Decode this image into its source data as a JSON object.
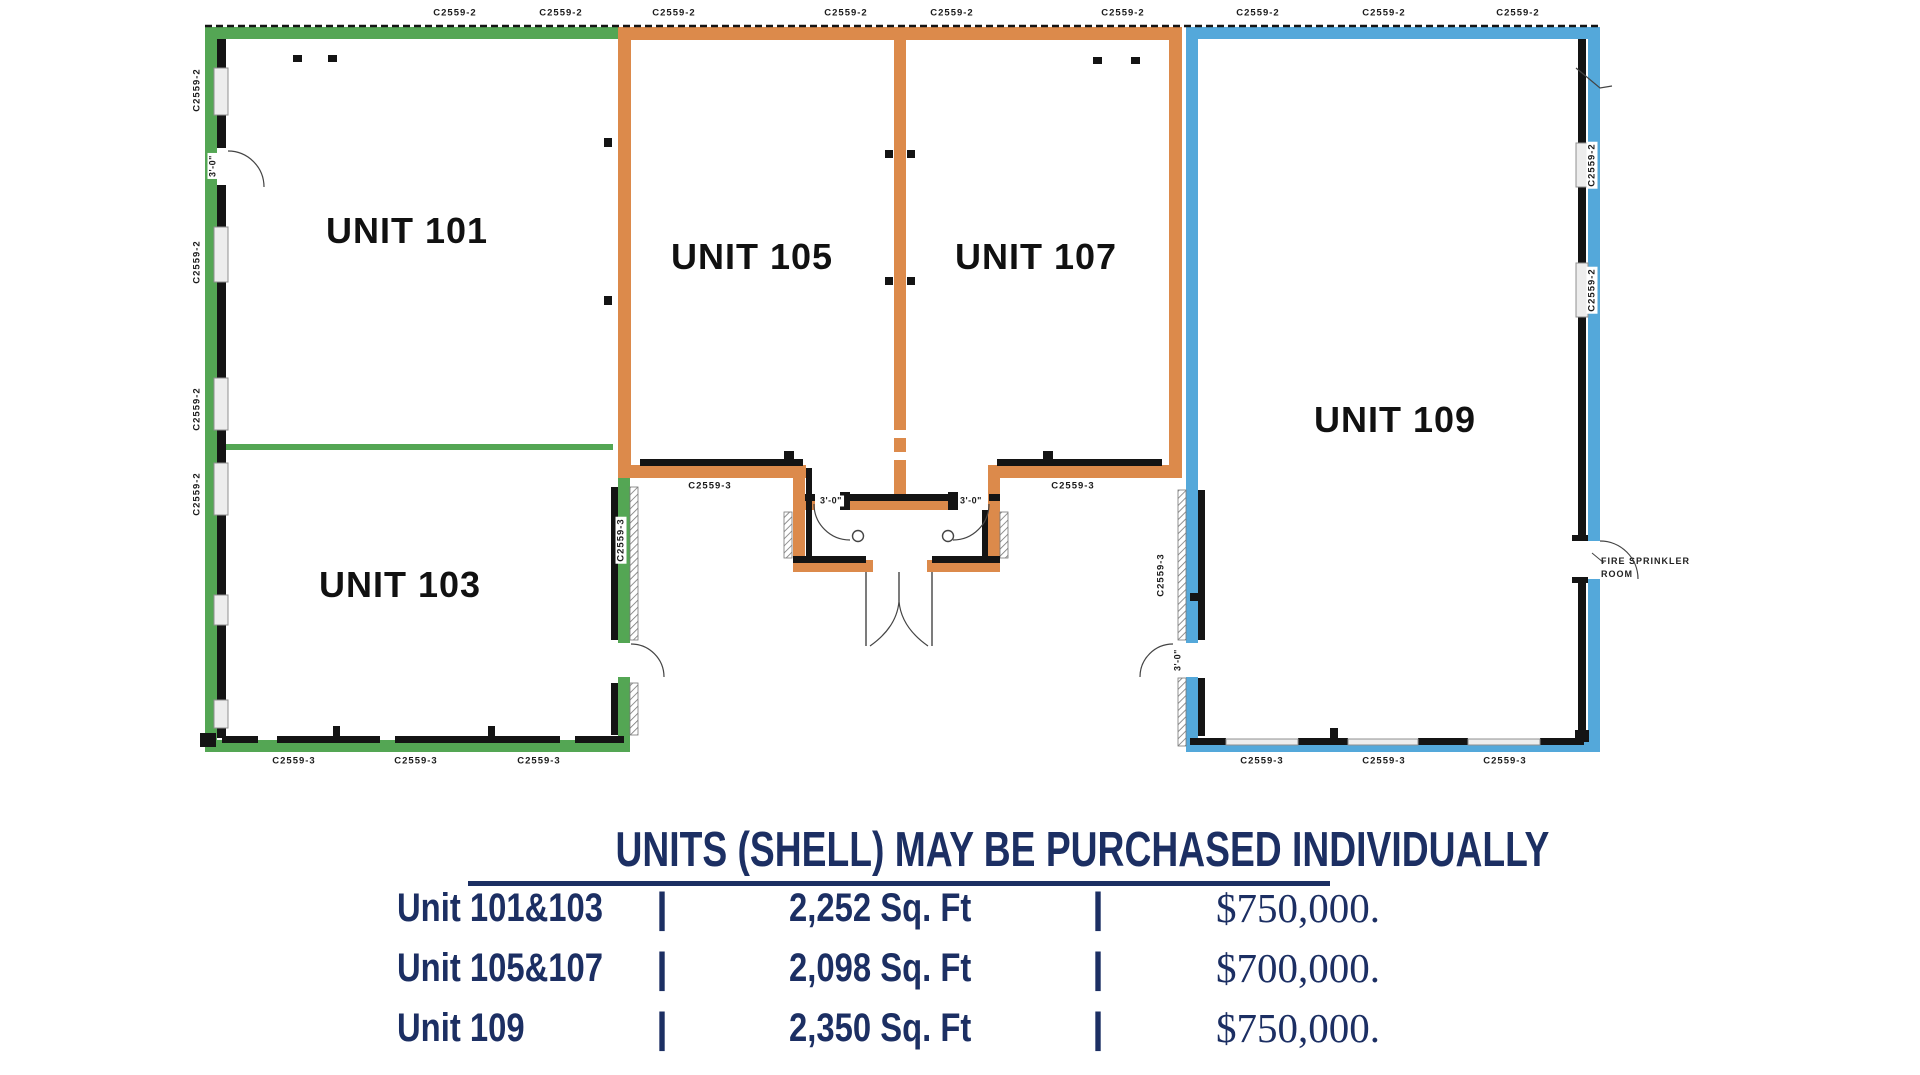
{
  "colors": {
    "green": "#54a654",
    "orange": "#dc8a4b",
    "blue": "#54a8da",
    "navy": "#1c2f63",
    "wall": "#141414"
  },
  "floor_plan": {
    "units": [
      {
        "id": "unit-101",
        "label": "UNIT 101"
      },
      {
        "id": "unit-103",
        "label": "UNIT 103"
      },
      {
        "id": "unit-105",
        "label": "UNIT 105"
      },
      {
        "id": "unit-107",
        "label": "UNIT 107"
      },
      {
        "id": "unit-109",
        "label": "UNIT 109"
      }
    ],
    "plan_labels": {
      "top": [
        {
          "text": "C2559-2",
          "x": 455,
          "y": 13
        },
        {
          "text": "C2559-2",
          "x": 561,
          "y": 13
        },
        {
          "text": "C2559-2",
          "x": 674,
          "y": 13
        },
        {
          "text": "C2559-2",
          "x": 846,
          "y": 13
        },
        {
          "text": "C2559-2",
          "x": 952,
          "y": 13
        },
        {
          "text": "C2559-2",
          "x": 1123,
          "y": 13
        },
        {
          "text": "C2559-2",
          "x": 1258,
          "y": 13
        },
        {
          "text": "C2559-2",
          "x": 1384,
          "y": 13
        },
        {
          "text": "C2559-2",
          "x": 1518,
          "y": 13
        }
      ],
      "left_wall": [
        {
          "text": "C2559-2",
          "x": 197,
          "y": 90,
          "rotate": true
        },
        {
          "text": "C2559-2",
          "x": 197,
          "y": 262,
          "rotate": true
        },
        {
          "text": "C2559-2",
          "x": 197,
          "y": 409,
          "rotate": true
        },
        {
          "text": "C2559-2",
          "x": 197,
          "y": 494,
          "rotate": true
        }
      ],
      "right_wall": [
        {
          "text": "C2559-2",
          "x": 1592,
          "y": 165,
          "rotate": true
        },
        {
          "text": "C2559-2",
          "x": 1592,
          "y": 290,
          "rotate": true
        }
      ],
      "bottom": [
        {
          "text": "C2559-3",
          "x": 294,
          "y": 761
        },
        {
          "text": "C2559-3",
          "x": 416,
          "y": 761
        },
        {
          "text": "C2559-3",
          "x": 539,
          "y": 761
        },
        {
          "text": "C2559-3",
          "x": 1262,
          "y": 761
        },
        {
          "text": "C2559-3",
          "x": 1384,
          "y": 761
        },
        {
          "text": "C2559-3",
          "x": 1505,
          "y": 761
        }
      ],
      "inner": [
        {
          "text": "C2559-3",
          "x": 710,
          "y": 486
        },
        {
          "text": "C2559-3",
          "x": 1073,
          "y": 486
        },
        {
          "text": "C2559-3",
          "x": 621,
          "y": 540,
          "rotate": true
        },
        {
          "text": "C2559-3",
          "x": 1161,
          "y": 575,
          "rotate": true
        }
      ],
      "doors": [
        {
          "text": "3'-0\"",
          "x": 831,
          "y": 501
        },
        {
          "text": "3'-0\"",
          "x": 971,
          "y": 501
        },
        {
          "text": "3'-0\"",
          "x": 213,
          "y": 166,
          "rotate": true
        },
        {
          "text": "3'-0\"",
          "x": 1178,
          "y": 660,
          "rotate": true
        }
      ]
    },
    "annotations": {
      "fire_sprinkler": {
        "line1": "FIRE SPRINKLER",
        "line2": "ROOM"
      }
    }
  },
  "pricing": {
    "title": "UNITS (SHELL) MAY BE PURCHASED INDIVIDUALLY",
    "rows": [
      {
        "unit": "Unit 101&103",
        "sep": "|",
        "area": "2,252 Sq. Ft",
        "price": "$750,000."
      },
      {
        "unit": "Unit 105&107",
        "sep": "|",
        "area": "2,098 Sq. Ft",
        "price": "$700,000."
      },
      {
        "unit": "Unit 109",
        "sep": "|",
        "area": "2,350 Sq. Ft",
        "price": "$750,000."
      }
    ]
  }
}
